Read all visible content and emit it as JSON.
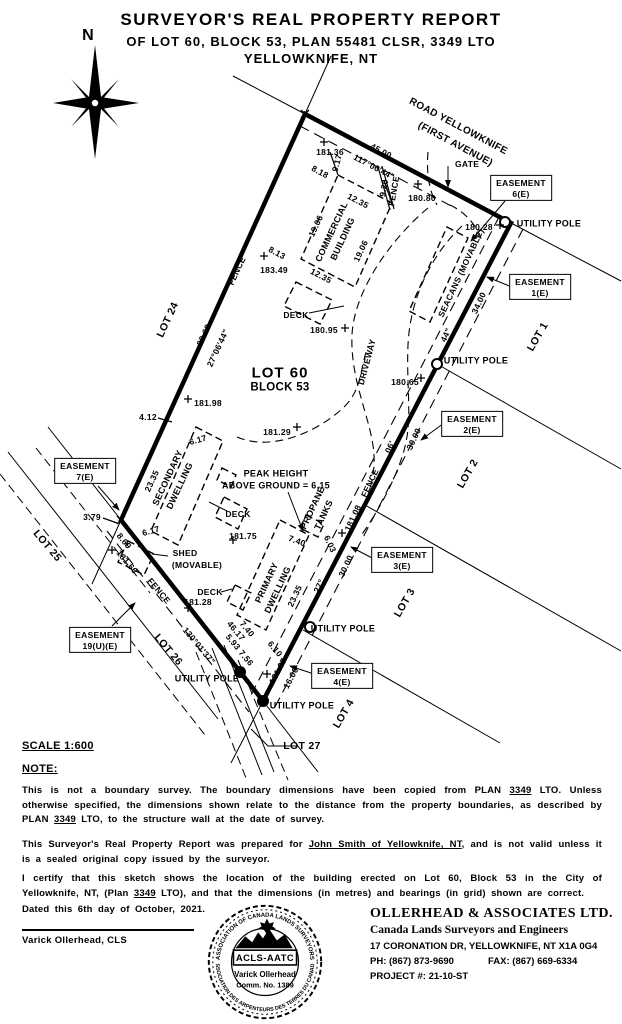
{
  "title": {
    "line1": "SURVEYOR'S REAL PROPERTY REPORT",
    "line2": "OF LOT 60, BLOCK 53, PLAN 55481 CLSR, 3349 LTO",
    "line3": "YELLOWKNIFE, NT"
  },
  "compass": {
    "north": "N"
  },
  "plan": {
    "road_line1": "ROAD YELLOWKNIFE",
    "road_line2": "(FIRST AVENUE)",
    "gate": "GATE",
    "fence": "FENCE",
    "utility_pole": "UTILITY POLE",
    "deck": "DECK",
    "shed_line1": "SHED",
    "shed_line2": "(MOVABLE)",
    "seacans": "SEACANS (MOVABLE)",
    "commercial_line1": "COMMERCIAL",
    "commercial_line2": "BUILDING",
    "secondary_line1": "SECONDARY",
    "secondary_line2": "DWELLING",
    "primary_line1": "PRIMARY",
    "primary_line2": "DWELLING",
    "propane_line1": "PROPANE",
    "propane_line2": "TANKS",
    "driveway": "DRIVEWAY",
    "peak_line1": "PEAK HEIGHT",
    "peak_line2": "ABOVE GROUND = 6.15",
    "lot60": "LOT 60",
    "block53": "BLOCK 53",
    "lot24": "LOT 24",
    "lot25": "LOT 25",
    "lot26": "LOT 26",
    "lot27": "LOT 27",
    "lot1": "LOT 1",
    "lot2": "LOT 2",
    "lot3": "LOT 3",
    "lot4": "LOT 4",
    "easement": "EASEMENT",
    "e6": "6(E)",
    "e1": "1(E)",
    "e2": "2(E)",
    "e3": "3(E)",
    "e4": "4(E)",
    "e7": "7(E)",
    "e19": "19(U)(E)",
    "brg_top": "117°06'44\"",
    "brg_left": "27°06'44\"",
    "brg_bottom": "130°01'37\"",
    "frag_44": "44\"",
    "frag_06": "06'",
    "frag_27": "27°",
    "len_top": "45.00",
    "len_left": "99.68",
    "len_bottom": "46.17",
    "seg_34": "34.00",
    "seg_30": "30.00",
    "seg_16": "16.00",
    "d_8_18": "8.18",
    "d_9_17": "9.17",
    "d_12_35": "12.35",
    "d_19_06": "19.06",
    "d_8_13": "8.13",
    "d_9_20": "9.20",
    "d_4_12": "4.12",
    "d_6_17": "6.17",
    "d_23_35": "23.35",
    "d_3_79": "3.79",
    "d_8_69": "8.69",
    "d_7_40": "7.40",
    "d_6_03": "6.03",
    "d_5_93": "5.93",
    "d_7_56": "7.56",
    "d_6_10": "6.10",
    "el_181_36": "181.36",
    "el_183_49": "183.49",
    "el_180_95": "180.95",
    "el_180_80": "180.80",
    "el_180_28": "180.28",
    "el_181_98": "181.98",
    "el_181_29": "181.29",
    "el_180_65": "180.65",
    "el_181_75": "181.75",
    "el_181_08": "181.08",
    "el_181_66": "181.66",
    "el_181_28": "181.28",
    "el_181_37": "181.37"
  },
  "footer": {
    "scale": "SCALE 1:600",
    "note_heading": "NOTE:",
    "p1a": "This is not a boundary survey. The boundary dimensions have been copied from PLAN ",
    "p1u1": "3349",
    "p1b": " LTO. Unless otherwise specified, the dimensions shown relate to the distance from the property boundaries, as described by PLAN ",
    "p1u2": "3349",
    "p1c": " LTO, to the structure wall at the date of survey.",
    "p2a": "This Surveyor's Real Property Report was prepared for ",
    "p2u1": "John Smith of Yellowknife, NT",
    "p2b": ", and is not valid unless it is a sealed original copy issued by the surveyor.",
    "p3a": "I certify that this sketch shows the location of the building erected on Lot 60, Block 53 in the City of Yellowknife, NT, (Plan ",
    "p3u1": "3349",
    "p3b": " LTO), and that the dimensions (in metres) and bearings (in grid) shown are correct.",
    "dated": "Dated this 6th day of October, 2021.",
    "signatory": "Varick Ollerhead, CLS",
    "company_name": "OLLERHEAD & ASSOCIATES LTD.",
    "company_sub": "Canada Lands Surveyors and Engineers",
    "company_addr": "17 CORONATION DR, YELLOWKNIFE, NT X1A 0G4",
    "company_ph": "PH: (867) 873-9690",
    "company_fax": "FAX: (867) 669-6334",
    "company_project": "PROJECT #: 21-10-ST"
  },
  "seal": {
    "arc_top": "ASSOCIATION OF CANADA LANDS SURVEYORS",
    "arc_bottom": "ASSOCIATION DES ARPENTEURS DES TERRES DU CANADA",
    "logo": "ACLS-AATC",
    "name": "Varick Ollerhead",
    "comm": "Comm. No. 1389"
  }
}
